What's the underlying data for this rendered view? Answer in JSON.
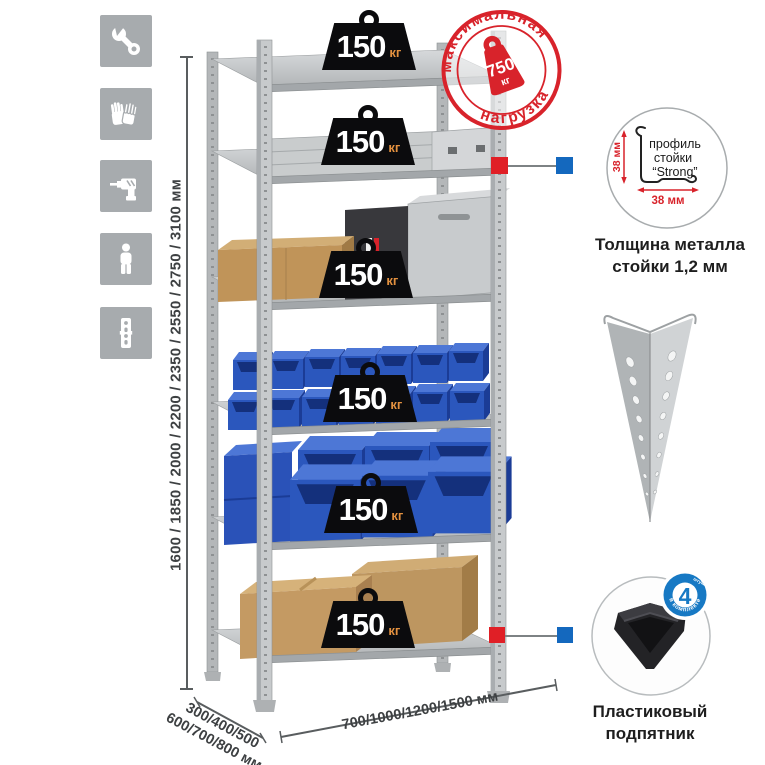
{
  "colors": {
    "accent_red": "#d8232b",
    "connector_red": "#e01f26",
    "connector_blue": "#1468be",
    "badge_blue": "#1779c4",
    "bin_blue": "#2b57bd",
    "weight_black": "#0b0b0d",
    "metal_gray": "#c3c6c8"
  },
  "left_rail": {
    "icons": [
      {
        "name": "wrench-icon"
      },
      {
        "name": "gloves-icon"
      },
      {
        "name": "drill-icon"
      },
      {
        "name": "person-icon"
      },
      {
        "name": "post-profile-icon"
      }
    ]
  },
  "height_dimension": {
    "label": "1600 / 1850 / 2000 / 2200 / 2350 / 2550 / 2750 / 3100 мм"
  },
  "depth_dimension": {
    "line1": "300/400/500",
    "line2": "600/700/800 мм"
  },
  "width_dimension": {
    "label": "700/1000/1200/1500 мм"
  },
  "shelf_load": {
    "value": "150",
    "unit": "кг"
  },
  "max_load_stamp": {
    "arc_top": "максимальная",
    "arc_bottom": "нагрузка",
    "value": "750",
    "unit": "кг"
  },
  "profile_detail": {
    "line1": "профиль",
    "line2": "стойки",
    "line3": "“Strong”",
    "vertical_dim": "38 мм",
    "horizontal_dim": "38 мм",
    "caption1": "Толщина металла",
    "caption2": "стойки 1,2 мм"
  },
  "foot_detail": {
    "badge_value": "4",
    "badge_small": "штуки",
    "badge_arc": "в комплекте",
    "caption1": "Пластиковый",
    "caption2": "подпятник"
  }
}
